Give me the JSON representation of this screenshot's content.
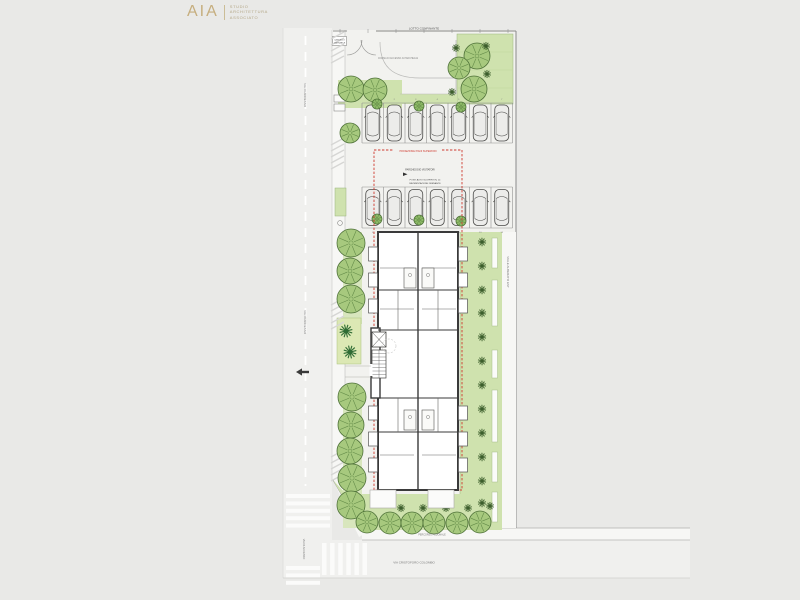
{
  "logo": {
    "mark": "AIA",
    "line1": "STUDIO",
    "line2": "ARCHITETTURA",
    "line3": "ASSOCIATO"
  },
  "labels": {
    "neighbor_lot": "LOTTO CONFINANTE",
    "gate_line1": "CANCELLO",
    "gate_line2": "CARRABILE",
    "driveway": "CORSIA DI ACCESSO AI PARCHEGGI",
    "projection": "PROIEZIONE PIANI SUPERIORI",
    "parking_note1": "PARCHEGGIO VISITATORI",
    "parking_note2": "POSTI AUTO SCOPERTI N. 14",
    "parking_note3": "PAVIMENTAZIONE DRENANTE",
    "street_right": "VIALE ALBERATO EST",
    "street_left_top": "VIA DI ACCESSO",
    "street_left_mid": "VIA DI ACCESSO",
    "street_left_bottom": "VIA DI ACCESSO",
    "walkway": "PERCORSO PEDONALE",
    "street_bottom": "VIA CRISTOFORO COLOMBO"
  },
  "colors": {
    "background": "#e9e9e7",
    "street": "#f0f0ee",
    "paving": "#f2f2ef",
    "sidewalk": "#f7f7f5",
    "green": "#cfe2ae",
    "green_light": "#d8e6bd",
    "planter": "#dce8b4",
    "tree_fill": "#a7c97e",
    "tree_fill_small": "#8fbc68",
    "tree_stroke": "#4e7138",
    "tree_spoke": "#648c49",
    "bush": "#3c5e2c",
    "palm": "#2e6b33",
    "wall": "#3a3a3a",
    "red": "#cf3b30",
    "line": "#9a9a98",
    "logo": "#c6ae7e"
  },
  "plan": {
    "trees": [
      [
        351,
        89,
        13
      ],
      [
        375,
        90,
        12
      ],
      [
        477,
        56,
        13
      ],
      [
        459,
        68,
        11
      ],
      [
        474,
        89,
        13
      ],
      [
        350,
        133,
        10
      ],
      [
        351,
        243,
        14
      ],
      [
        350,
        271,
        13
      ],
      [
        351,
        299,
        14
      ],
      [
        352,
        397,
        14
      ],
      [
        351,
        425,
        13
      ],
      [
        350,
        451,
        13
      ],
      [
        352,
        478,
        14
      ],
      [
        351,
        505,
        14
      ],
      [
        367,
        522,
        11
      ],
      [
        390,
        523,
        11
      ],
      [
        412,
        523,
        11
      ],
      [
        434,
        523,
        11
      ],
      [
        457,
        523,
        11
      ],
      [
        480,
        522,
        11
      ]
    ],
    "small_trees": [
      [
        377,
        104
      ],
      [
        419,
        106
      ],
      [
        461,
        107
      ],
      [
        377,
        219
      ],
      [
        419,
        220
      ],
      [
        461,
        221
      ]
    ],
    "bushes": [
      [
        456,
        48
      ],
      [
        486,
        46
      ],
      [
        452,
        92
      ],
      [
        487,
        74
      ],
      [
        401,
        508
      ],
      [
        423,
        508
      ],
      [
        446,
        508
      ],
      [
        468,
        508
      ],
      [
        490,
        506
      ]
    ],
    "bush_column": {
      "x": 482,
      "ys": [
        242,
        266,
        290,
        313,
        337,
        361,
        385,
        409,
        433,
        457,
        481,
        503
      ]
    },
    "palms": [
      [
        346,
        331
      ],
      [
        350,
        352
      ]
    ],
    "planters": [
      [
        492,
        238,
        30
      ],
      [
        492,
        280,
        46
      ],
      [
        492,
        350,
        28
      ],
      [
        492,
        390,
        52
      ],
      [
        492,
        452,
        30
      ],
      [
        492,
        492,
        30
      ]
    ],
    "parking_rows": [
      {
        "y0": 103,
        "y1": 143,
        "x0": 362,
        "stall_w": 21.5,
        "stalls": 7,
        "car_y": 123,
        "num_y": 100,
        "start": 1
      },
      {
        "y0": 187,
        "y1": 228,
        "x0": 362,
        "stall_w": 21.5,
        "stalls": 7,
        "car_y": 207.5,
        "num_y": 233,
        "start": 8
      }
    ],
    "balconies": {
      "left_ys": [
        247,
        273,
        299,
        406,
        432,
        458
      ],
      "right_ys": [
        247,
        273,
        299,
        406,
        432,
        458
      ]
    },
    "zebra": [
      {
        "x": 286,
        "y": 494,
        "w": 44,
        "h": 4,
        "gap": 3.4,
        "count": 5,
        "dir": "h"
      },
      {
        "x": 322,
        "y": 543,
        "w": 4.5,
        "h": 32,
        "gap": 3.6,
        "count": 6,
        "dir": "v"
      },
      {
        "x": 286,
        "y": 566,
        "w": 34,
        "h": 4,
        "gap": 3.4,
        "count": 3,
        "dir": "h"
      }
    ],
    "ramps": [
      [
        331,
        34
      ],
      [
        331,
        140
      ],
      [
        331,
        300
      ],
      [
        331,
        452
      ]
    ],
    "ticks": {
      "y": 31,
      "x0": 340,
      "x1": 512,
      "step": 28
    }
  }
}
